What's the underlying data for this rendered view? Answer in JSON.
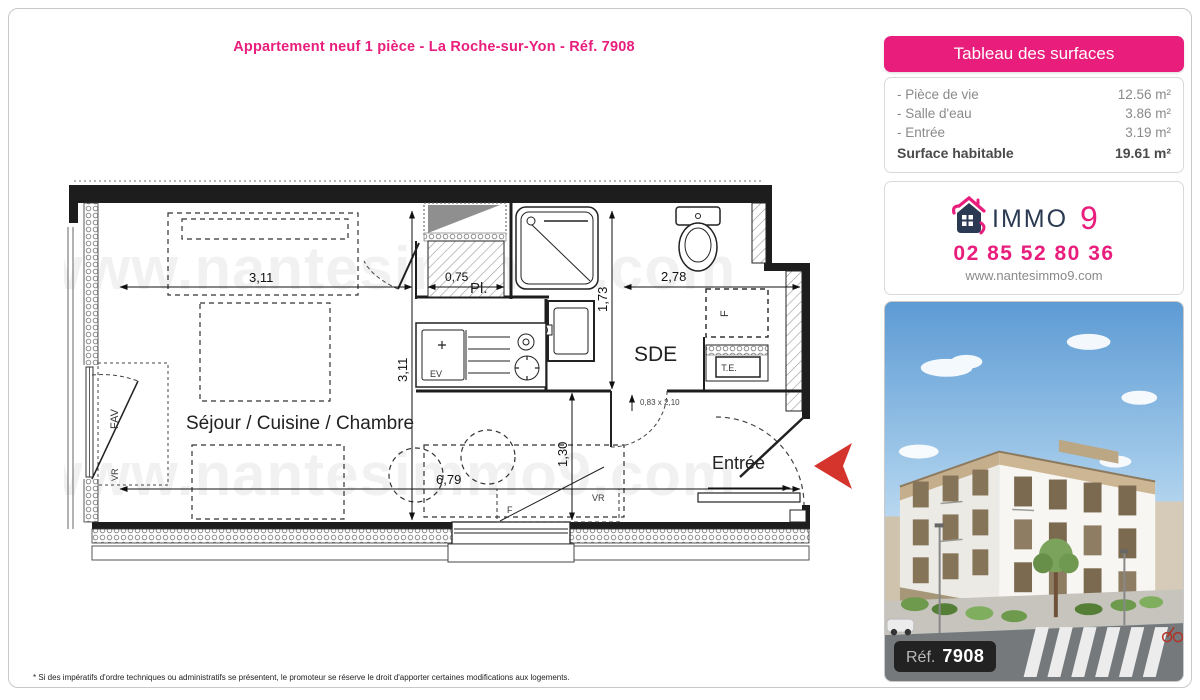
{
  "page": {
    "title": "Appartement neuf 1 pièce - La Roche-sur-Yon - Réf. 7908",
    "footnote": "* Si des impératifs d'ordre techniques ou administratifs se présentent, le promoteur se réserve le droit d'apporter certaines modifications aux logements.",
    "accent_color": "#e81d7c"
  },
  "surfaces_panel": {
    "title": "Tableau des surfaces",
    "rows": [
      {
        "label": "- Pièce de vie",
        "value": "12.56 m²"
      },
      {
        "label": "- Salle d'eau",
        "value": "3.86 m²"
      },
      {
        "label": "- Entrée",
        "value": "3.19 m²"
      }
    ],
    "total_label": "Surface habitable",
    "total_value": "19.61 m²"
  },
  "agency_panel": {
    "brand": "IMMO",
    "brand_number": "9",
    "phone": "02 85 52 80 36",
    "website": "www.nantesimmo9.com"
  },
  "photo_panel": {
    "ref_label": "Réf.",
    "ref_number": "7908"
  },
  "floorplan": {
    "watermark": "www.nantesimmo9.com",
    "rooms": {
      "main": "Séjour / Cuisine / Chambre",
      "bathroom": "SDE",
      "entrance": "Entrée",
      "closet": "Pl."
    },
    "fixtures": {
      "sink": "EV",
      "electrical_panel": "T.E.",
      "fridge": "F",
      "bottom_window": "F",
      "bottom_shutter": "VR",
      "left_window": "FAV",
      "left_shutter": "VR"
    },
    "dims": {
      "main_width": "3,11",
      "main_height": "3,11",
      "closet_width": "0,75",
      "sde_height": "1,73",
      "sde_width": "2,78",
      "total_width": "6,79",
      "hall_height": "1,30",
      "door_size": "0,83 x 2,10"
    }
  }
}
